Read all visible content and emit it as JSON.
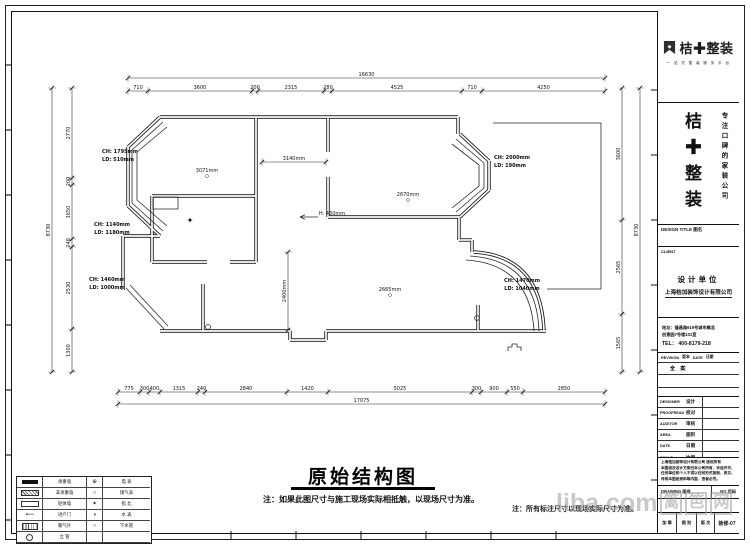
{
  "brand": {
    "logo_text": "桔✚整装",
    "tagline": "一 站 式 整 装 服 务 平 台",
    "name_vertical": "桔✚整装",
    "slogan_vertical": "专注口碑的家装公司"
  },
  "titleblock": {
    "design_title_label": "DESIGN TITLE 图名",
    "client_label": "CLIENT",
    "design_unit": "设计单位",
    "company": "上海桔加装饰设计有限公司",
    "addr1": "地址：隆昌路619号城市概念",
    "addr2": "创意园7号楼101室",
    "tel": "TEL： 400-8179-218",
    "revision_header": [
      "REVISION",
      "版本",
      "DATE",
      "日期"
    ],
    "revision_rows": [
      "全 案",
      "",
      ""
    ],
    "info_rows": [
      {
        "en": "DESIGNER",
        "cn": "设计"
      },
      {
        "en": "PROOFREAD",
        "cn": "校对"
      },
      {
        "en": "AUDITOR",
        "cn": "审核"
      },
      {
        "en": "AREA",
        "cn": "面积"
      },
      {
        "en": "DATE",
        "cn": "日期"
      },
      {
        "en": "SCALE",
        "cn": "比例"
      }
    ],
    "copyright_lines": [
      "上海桔加装饰设计有限公司 版权所有",
      "本图纸及设计方案归本公司所有，未经许可，",
      "任何单位和个人不得以任何形式复制、拷贝、",
      "传阅本图纸资料等内容，违者必究。"
    ],
    "drawing_no_label": "DRAWING 图号",
    "page_no_label": "NO 页码",
    "bottom_cells": [
      "加 章",
      "图 别",
      "版 次",
      "装修-07"
    ]
  },
  "drawing": {
    "title": "原始结构图",
    "note_main": "注：如果此图尺寸与施工现场实际相抵触，以现场尺寸为准。",
    "note_secondary": "注：所有标注尺寸以现场实际尺寸为准。",
    "dims": {
      "h": [
        {
          "y": 78,
          "x": 128,
          "parts": [
            {
              "v": "16630",
              "w": 477
            }
          ]
        },
        {
          "y": 91,
          "x": 128,
          "parts": [
            {
              "v": "710",
              "w": 20
            },
            {
              "v": "3600",
              "w": 104
            },
            {
              "v": "200",
              "w": 6
            },
            {
              "v": "2315",
              "w": 66
            },
            {
              "v": "280",
              "w": 8
            },
            {
              "v": "4525",
              "w": 130
            },
            {
              "v": "710",
              "w": 20
            },
            {
              "v": "4250",
              "w": 123
            }
          ]
        },
        {
          "y": 392,
          "x": 118,
          "parts": [
            {
              "v": "775",
              "w": 22
            },
            {
              "v": "300",
              "w": 9
            },
            {
              "v": "400",
              "w": 11
            },
            {
              "v": "1315",
              "w": 38
            },
            {
              "v": "240",
              "w": 7
            },
            {
              "v": "2840",
              "w": 82
            },
            {
              "v": "1420",
              "w": 41
            },
            {
              "v": "5025",
              "w": 144
            },
            {
              "v": "300",
              "w": 9
            },
            {
              "v": "900",
              "w": 26
            },
            {
              "v": "550",
              "w": 16
            },
            {
              "v": "2850",
              "w": 82
            }
          ]
        },
        {
          "y": 404,
          "x": 118,
          "parts": [
            {
              "v": "17075",
              "w": 487
            }
          ]
        },
        {
          "y": 162,
          "x": 262,
          "parts": [
            {
              "v": "3140mm",
              "w": 64
            }
          ]
        }
      ],
      "v": [
        {
          "x": 52,
          "y": 88,
          "parts": [
            {
              "v": "8730",
              "w": 284
            }
          ]
        },
        {
          "x": 72,
          "y": 88,
          "parts": [
            {
              "v": "2770",
              "w": 90
            },
            {
              "v": "200",
              "w": 7
            },
            {
              "v": "1650",
              "w": 54
            },
            {
              "v": "240",
              "w": 8
            },
            {
              "v": "2530",
              "w": 82
            },
            {
              "v": "1300",
              "w": 43
            }
          ]
        },
        {
          "x": 622,
          "y": 88,
          "parts": [
            {
              "v": "3600",
              "w": 132
            },
            {
              "v": "2565",
              "w": 94
            },
            {
              "v": "1565",
              "w": 58
            }
          ]
        },
        {
          "x": 640,
          "y": 88,
          "parts": [
            {
              "v": "8730",
              "w": 284
            }
          ]
        },
        {
          "x": 288,
          "y": 252,
          "parts": [
            {
              "v": "2400mm",
              "w": 78
            }
          ]
        }
      ]
    },
    "labels": [
      {
        "t": "CH: 1795mm",
        "x": 120,
        "y": 153,
        "b": 1
      },
      {
        "t": "LD: 510mm",
        "x": 118,
        "y": 161,
        "b": 1
      },
      {
        "t": "3071mm",
        "x": 207,
        "y": 172,
        "marker": 1
      },
      {
        "t": "2670mm",
        "x": 408,
        "y": 196,
        "marker": 1
      },
      {
        "t": "CH: 2000mm",
        "x": 512,
        "y": 159,
        "b": 1
      },
      {
        "t": "LD: 190mm",
        "x": 510,
        "y": 167,
        "b": 1
      },
      {
        "t": "CH: 1140mm",
        "x": 112,
        "y": 226,
        "b": 1
      },
      {
        "t": "LD: 1180mm",
        "x": 112,
        "y": 234,
        "b": 1
      },
      {
        "t": "H: 430mm",
        "x": 332,
        "y": 215
      },
      {
        "t": "CH: 1460mm",
        "x": 107,
        "y": 281,
        "b": 1
      },
      {
        "t": "LD: 1000mm",
        "x": 107,
        "y": 289,
        "b": 1
      },
      {
        "t": "2665mm",
        "x": 390,
        "y": 291,
        "marker": 1
      },
      {
        "t": "CH: 1470mm",
        "x": 522,
        "y": 282,
        "b": 1
      },
      {
        "t": "LD: 1040mm",
        "x": 522,
        "y": 290,
        "b": 1
      },
      {
        "t": "✦",
        "x": 190,
        "y": 223,
        "fs": 8
      }
    ]
  },
  "legend": {
    "rows": [
      {
        "sym1": "lg-solid",
        "label1": "承重墙",
        "sym2": "⊕",
        "label2": "电 表"
      },
      {
        "sym1": "lg-hatch",
        "label1": "非承重墙",
        "sym2": "○",
        "label2": "煤气表"
      },
      {
        "sym1": "lg-open",
        "label1": "轻体墙",
        "sym2": "✦",
        "label2": "指 北"
      },
      {
        "sym1": "lg-door",
        "label1": "进户门",
        "sym2": "◑",
        "label2": "水 表"
      },
      {
        "sym1": "lg-rad",
        "label1": "暖气片",
        "sym2": "○",
        "label2": "下水管"
      },
      {
        "sym1": "lg-pipe",
        "label1": "立 管",
        "sym2": "",
        "label2": ""
      }
    ]
  },
  "watermark": {
    "text": "liba",
    "suffix": ".com",
    "boxed": [
      "篱",
      "笆",
      "网"
    ]
  }
}
